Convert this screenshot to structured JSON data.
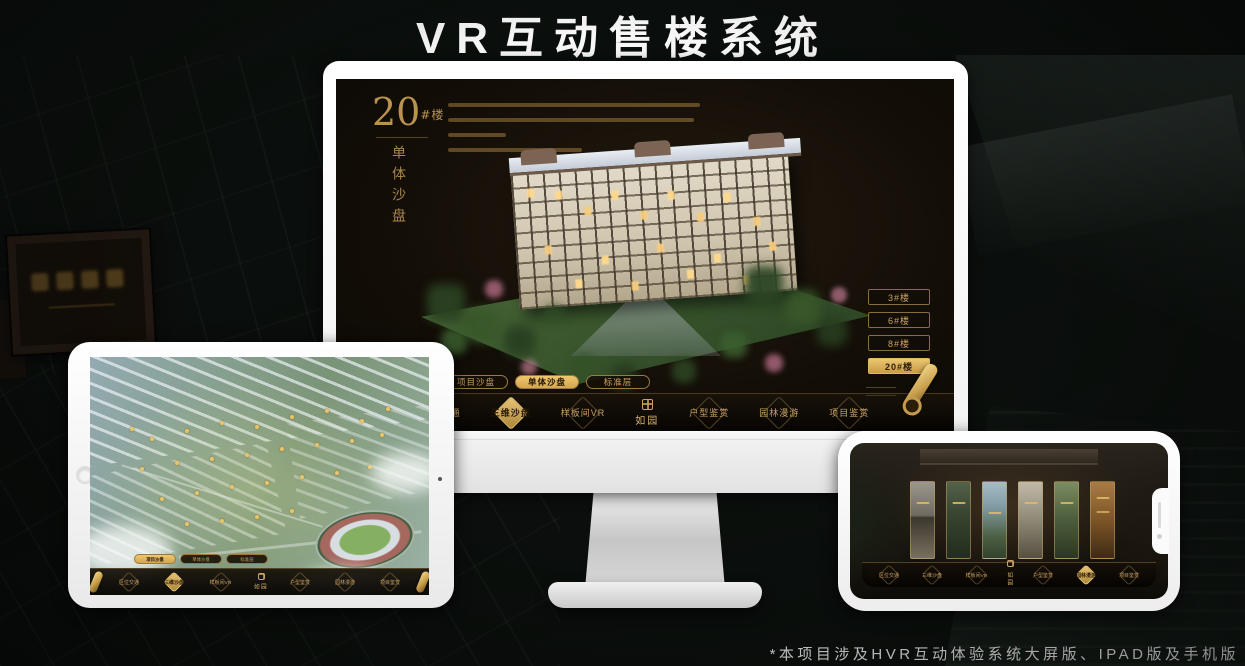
{
  "page": {
    "title": "VR互动售楼系统",
    "footnote": "*本项目涉及HVR互动体验系统大屏版、IPAD版及手机版"
  },
  "colors": {
    "gold": "#c9a264",
    "gold_active": "#e4bd6a",
    "screen_bg": "#15100a",
    "device_body": "#ffffff"
  },
  "monitor": {
    "headline": {
      "number": "20",
      "suffix": "#楼",
      "subtitle": "单体沙盘"
    },
    "floor_buttons": [
      {
        "label": "3#楼",
        "active": false
      },
      {
        "label": "6#楼",
        "active": false
      },
      {
        "label": "8#楼",
        "active": false
      },
      {
        "label": "20#楼",
        "active": true
      }
    ],
    "sub_tabs": [
      {
        "label": "项目沙盘",
        "active": false
      },
      {
        "label": "单体沙盘",
        "active": true
      },
      {
        "label": "标准层",
        "active": false
      }
    ]
  },
  "nav": {
    "logo": "如园",
    "items": [
      {
        "label": "区位交通"
      },
      {
        "label": "三维沙盘"
      },
      {
        "label": "样板间VR"
      },
      {
        "label": "户型鉴赏"
      },
      {
        "label": "园林漫游"
      },
      {
        "label": "项目鉴赏"
      }
    ],
    "active_item": {
      "desktop": "三维沙盘",
      "tablet": "三维沙盘",
      "phone": "园林漫游"
    }
  },
  "tablet": {
    "sub_tabs": [
      {
        "label": "项目沙盘",
        "active": true
      },
      {
        "label": "单体沙盘",
        "active": false
      },
      {
        "label": "标准层",
        "active": false
      }
    ]
  }
}
